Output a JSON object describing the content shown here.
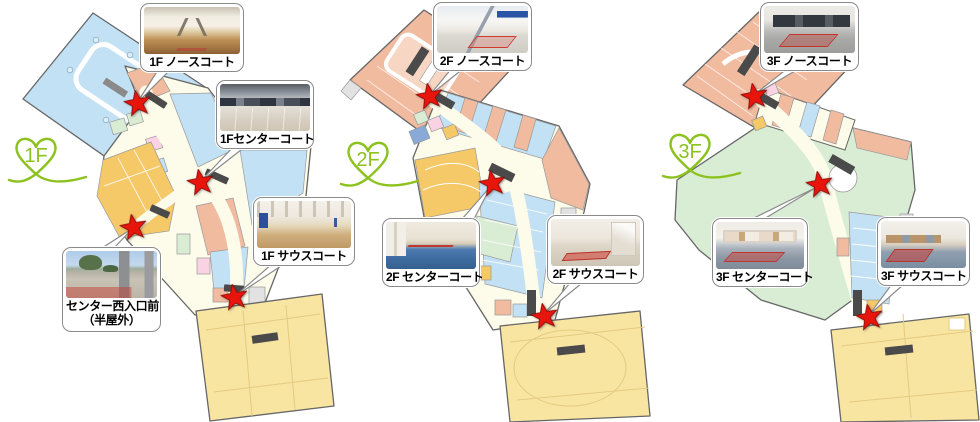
{
  "colors": {
    "logo_green": "#8CC21E",
    "star_red": "#E8150D",
    "star_outline": "#8F0D08",
    "callout_border": "#8A8A8A",
    "map_outline": "#666666",
    "corridor_cream": "#FDFBE9",
    "shop_light_blue": "#C3E1F4",
    "shop_salmon": "#F1BB9F",
    "shop_amber": "#F5C868",
    "anchor_yellow": "#F9E5A2",
    "shop_green": "#D9EDD5",
    "shop_pink": "#F9D3E3",
    "shop_gray": "#E2E2E2",
    "shop_blue": "#89A9D8",
    "escalator_dark": "#4A4A4A"
  },
  "icons": {
    "marker": "star-icon",
    "logo": "heart-ribbon-icon"
  },
  "floors": [
    {
      "id": "1f",
      "logo": "1F",
      "callouts": {
        "north": {
          "label": "1F ノースコート"
        },
        "center": {
          "label": "1Fセンターコート"
        },
        "south": {
          "label": "1F サウスコート"
        },
        "west": {
          "label": "センター西入口前",
          "label2": "（半屋外）"
        }
      }
    },
    {
      "id": "2f",
      "logo": "2F",
      "callouts": {
        "north": {
          "label": "2F ノースコート"
        },
        "center": {
          "label": "2F センターコート"
        },
        "south": {
          "label": "2F サウスコート"
        }
      }
    },
    {
      "id": "3f",
      "logo": "3F",
      "callouts": {
        "north": {
          "label": "3F ノースコート"
        },
        "center": {
          "label": "3F センターコート"
        },
        "south": {
          "label": "3F サウスコート"
        }
      }
    }
  ]
}
